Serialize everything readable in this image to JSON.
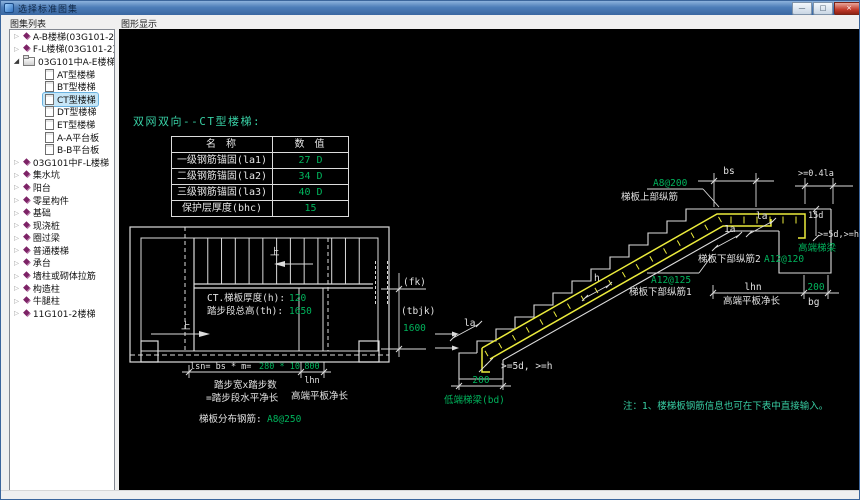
{
  "window": {
    "title": "选择标准图集",
    "minimize_label": "—",
    "maximize_label": "□",
    "close_label": "×"
  },
  "panels": {
    "left_header": "图集列表",
    "right_header": "图形显示"
  },
  "tree": {
    "items": [
      {
        "label": "A-B楼梯(03G101-2)",
        "icon": "box",
        "expander": "collapsed"
      },
      {
        "label": "F-L楼梯(03G101-2)",
        "icon": "box",
        "expander": "collapsed"
      },
      {
        "label": "03G101中A-E楼梯",
        "icon": "folder",
        "expander": "expanded"
      },
      {
        "label": "AT型楼梯",
        "icon": "doc",
        "child": true
      },
      {
        "label": "BT型楼梯",
        "icon": "doc",
        "child": true
      },
      {
        "label": "CT型楼梯",
        "icon": "doc",
        "child": true,
        "selected": true
      },
      {
        "label": "DT型楼梯",
        "icon": "doc",
        "child": true
      },
      {
        "label": "ET型楼梯",
        "icon": "doc",
        "child": true
      },
      {
        "label": "A-A平台板",
        "icon": "doc",
        "child": true
      },
      {
        "label": "B-B平台板",
        "icon": "doc",
        "child": true
      },
      {
        "label": "03G101中F-L楼梯",
        "icon": "box",
        "expander": "collapsed"
      },
      {
        "label": "集水坑",
        "icon": "box",
        "expander": "collapsed"
      },
      {
        "label": "阳台",
        "icon": "box",
        "expander": "collapsed"
      },
      {
        "label": "零星构件",
        "icon": "box",
        "expander": "collapsed"
      },
      {
        "label": "基础",
        "icon": "box",
        "expander": "collapsed"
      },
      {
        "label": "现浇桩",
        "icon": "box",
        "expander": "collapsed"
      },
      {
        "label": "圈过梁",
        "icon": "box",
        "expander": "collapsed"
      },
      {
        "label": "普通楼梯",
        "icon": "box",
        "expander": "collapsed"
      },
      {
        "label": "承台",
        "icon": "box",
        "expander": "collapsed"
      },
      {
        "label": "墙柱或砌体拉筋",
        "icon": "box",
        "expander": "collapsed"
      },
      {
        "label": "构造柱",
        "icon": "box",
        "expander": "collapsed"
      },
      {
        "label": "牛腿柱",
        "icon": "box",
        "expander": "collapsed"
      },
      {
        "label": "11G101-2楼梯",
        "icon": "box",
        "expander": "collapsed"
      }
    ]
  },
  "canvas": {
    "title": "双网双向--CT型楼梯:",
    "param_table": {
      "headers": [
        "名  称",
        "数  值"
      ],
      "rows": [
        [
          "一级钢筋锚固(la1)",
          "27 D"
        ],
        [
          "二级钢筋锚固(la2)",
          "34 D"
        ],
        [
          "三级钢筋锚固(la3)",
          "40 D"
        ],
        [
          "保护层厚度(bhc)",
          "15"
        ]
      ]
    },
    "plan": {
      "up": "上",
      "thickness_label": "CT.梯板厚度(h):",
      "thickness_value": "120",
      "total_label": "踏步段总高(th):",
      "total_value": "1650",
      "fk": "(fk)",
      "tbjk": "(tbjk)",
      "v1600": "1600",
      "formula_label": "lsn= bs * m=",
      "formula_value": "280 * 10",
      "dim800": "800",
      "lhn": "lhn",
      "cap1": "踏步宽x踏步数",
      "cap2": "=踏步段水平净长",
      "cap3": "高端平板净长",
      "dist_label": "梯板分布钢筋:",
      "dist_value": "A8@250"
    },
    "elevation": {
      "bs": "bs",
      "ge04la": ">=0.4la",
      "upper_value": "A8@200",
      "upper_label": "梯板上部纵筋",
      "la_a": "1a",
      "la_b": "la",
      "lower2_label": "梯板下部纵筋2",
      "lower2_value": "A12@120",
      "lower1_value": "A12@125",
      "lower1_label": "梯板下部纵筋1",
      "lhn": "lhn",
      "lhn_caption": "高端平板净长",
      "dim200_right": "200",
      "bg": "bg",
      "high_beam": "高端梯梁",
      "d15": "15d",
      "ge5dh_right": ">=5d,>=h",
      "h": "h",
      "la_low": "la",
      "ge5dh_low": ">=5d, >=h",
      "dim200_left": "200",
      "low_beam": "低端梯梁(bd)"
    },
    "note": "注：1、楼梯板钢筋信息也可在下表中直接输入。"
  },
  "colors": {
    "canvas_bg": "#000000",
    "line": "#dcdcdc",
    "rebar": "#ecec3c",
    "green": "#00b35c",
    "teal": "#38cfa4",
    "titlebar_blue": "#4a7ab5",
    "selection": "#c6e6f7"
  }
}
